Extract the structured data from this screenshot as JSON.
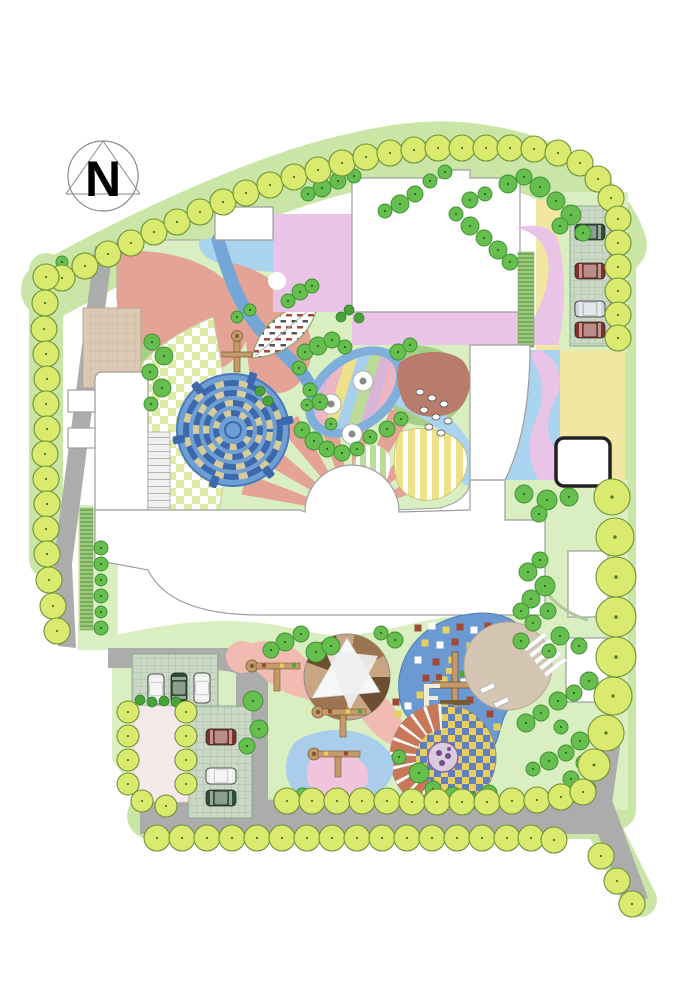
{
  "meta": {
    "north_label": "N"
  },
  "palette": {
    "paper": "#FFFFFF",
    "road": "#ACACAC",
    "roadEdge": "#979797",
    "lawn": "#D9EFC1",
    "lawnBand": "#C9E6A6",
    "treeYG": "#D9EA6F",
    "treeYGs": "#6F9238",
    "treeMG": "#66BE4E",
    "treeMGs": "#3E8F31",
    "shrubDark": "#47A33A",
    "salmon": "#E4A395",
    "salmonLight": "#F2BBB1",
    "blueStream": "#74A7D8",
    "blueLight": "#A9D3EF",
    "purple": "#D9ACDB",
    "pinkBig": "#EAC4E6",
    "greenBand": "#A5CF86",
    "yellowPale": "#F1E6A2",
    "terracotta": "#B97C6C",
    "mazeBlue": "#6D9FD4",
    "mazeWall": "#3C68AE",
    "mazeTan": "#D8CB9A",
    "beige": "#D5C6B4",
    "blueZone": "#6B9AD2",
    "pondBlue": "#ABCDEC",
    "pondPink": "#F0C4DD",
    "wood": "#C49A6A",
    "woodDark": "#7A5A32",
    "carWhite": "#EDEDED",
    "carGreen": "#2F4F33",
    "carRed": "#7E312A",
    "carSilver": "#CFD4DA",
    "outline": "#9E9E9E",
    "tanPlaza": "#DBC9B3",
    "arcTer": "#C87858",
    "checkYellow": "#E9CE5E",
    "checkBlue": "#5F7FBE",
    "pixelRed": "#A14A38",
    "pixelYellow": "#E8D05E",
    "hedge": "#9CCB7E"
  },
  "trees": {
    "perimeter": [
      [
        62,
        278
      ],
      [
        85,
        266
      ],
      [
        108,
        254
      ],
      [
        131,
        243
      ],
      [
        154,
        232
      ],
      [
        177,
        222
      ],
      [
        200,
        212
      ],
      [
        223,
        202
      ],
      [
        246,
        193
      ],
      [
        270,
        185
      ],
      [
        294,
        177
      ],
      [
        318,
        170
      ],
      [
        342,
        163
      ],
      [
        366,
        157
      ],
      [
        390,
        153
      ],
      [
        414,
        150
      ],
      [
        438,
        148
      ],
      [
        462,
        148
      ],
      [
        486,
        148
      ],
      [
        510,
        148
      ],
      [
        534,
        149
      ],
      [
        558,
        153
      ],
      [
        580,
        163
      ],
      [
        598,
        179
      ],
      [
        611,
        198
      ],
      [
        618,
        219
      ],
      [
        618,
        243
      ],
      [
        618,
        267
      ],
      [
        618,
        291
      ],
      [
        618,
        315
      ],
      [
        618,
        338
      ],
      [
        46,
        277
      ],
      [
        45,
        303
      ],
      [
        44,
        329
      ],
      [
        46,
        354
      ],
      [
        47,
        379
      ],
      [
        46,
        404
      ],
      [
        47,
        429
      ],
      [
        45,
        454
      ],
      [
        46,
        479
      ],
      [
        47,
        504
      ],
      [
        46,
        529
      ],
      [
        47,
        554
      ],
      [
        49,
        580
      ],
      [
        53,
        606
      ],
      [
        57,
        631
      ],
      [
        287,
        801
      ],
      [
        312,
        801
      ],
      [
        337,
        801
      ],
      [
        362,
        801
      ],
      [
        387,
        801
      ],
      [
        412,
        802
      ],
      [
        437,
        802
      ],
      [
        462,
        802
      ],
      [
        487,
        802
      ],
      [
        512,
        801
      ],
      [
        537,
        800
      ],
      [
        561,
        797
      ],
      [
        583,
        792
      ],
      [
        157,
        838
      ],
      [
        182,
        838
      ],
      [
        207,
        838
      ],
      [
        232,
        838
      ],
      [
        257,
        838
      ],
      [
        282,
        838
      ],
      [
        307,
        838
      ],
      [
        332,
        838
      ],
      [
        357,
        838
      ],
      [
        382,
        838
      ],
      [
        407,
        838
      ],
      [
        432,
        838
      ],
      [
        457,
        838
      ],
      [
        482,
        838
      ],
      [
        507,
        838
      ],
      [
        531,
        838
      ],
      [
        554,
        840
      ],
      [
        601,
        856
      ],
      [
        617,
        881
      ],
      [
        632,
        904
      ],
      [
        128,
        712,
        11
      ],
      [
        128,
        736,
        11
      ],
      [
        128,
        760,
        11
      ],
      [
        128,
        784,
        11
      ],
      [
        142,
        801,
        11
      ],
      [
        166,
        806,
        11
      ],
      [
        186,
        712,
        11
      ],
      [
        186,
        736,
        11
      ],
      [
        186,
        760,
        11
      ],
      [
        186,
        784,
        11
      ]
    ],
    "perimeterBig": [
      [
        612,
        497,
        18
      ],
      [
        615,
        537,
        19
      ],
      [
        616,
        577,
        20
      ],
      [
        616,
        617,
        20
      ],
      [
        616,
        657,
        20
      ],
      [
        613,
        696,
        19
      ],
      [
        606,
        733,
        18
      ],
      [
        594,
        765,
        16
      ]
    ],
    "canopy": [
      [
        322,
        188,
        9
      ],
      [
        338,
        181,
        8
      ],
      [
        308,
        194,
        7
      ],
      [
        354,
        176,
        7
      ],
      [
        508,
        184,
        9
      ],
      [
        524,
        177,
        8
      ],
      [
        540,
        187,
        10
      ],
      [
        556,
        201,
        9
      ],
      [
        571,
        215,
        10
      ],
      [
        560,
        226,
        8
      ],
      [
        470,
        200,
        8
      ],
      [
        485,
        194,
        7
      ],
      [
        445,
        172,
        7
      ],
      [
        430,
        181,
        7
      ],
      [
        415,
        194,
        8
      ],
      [
        400,
        204,
        9
      ],
      [
        385,
        211,
        7
      ],
      [
        456,
        214,
        7
      ],
      [
        470,
        226,
        9
      ],
      [
        484,
        238,
        8
      ],
      [
        498,
        250,
        9
      ],
      [
        510,
        262,
        8
      ],
      [
        583,
        233,
        8
      ],
      [
        62,
        262,
        6
      ],
      [
        152,
        342,
        8
      ],
      [
        164,
        356,
        9
      ],
      [
        150,
        372,
        8
      ],
      [
        162,
        388,
        9
      ],
      [
        151,
        404,
        7
      ],
      [
        300,
        292,
        8
      ],
      [
        288,
        301,
        7
      ],
      [
        312,
        286,
        7
      ],
      [
        305,
        352,
        8
      ],
      [
        318,
        346,
        9
      ],
      [
        332,
        340,
        8
      ],
      [
        345,
        347,
        7
      ],
      [
        299,
        368,
        7
      ],
      [
        398,
        352,
        8
      ],
      [
        410,
        345,
        7
      ],
      [
        302,
        430,
        8
      ],
      [
        314,
        441,
        9
      ],
      [
        327,
        449,
        8
      ],
      [
        342,
        453,
        8
      ],
      [
        357,
        449,
        7
      ],
      [
        331,
        424,
        6
      ],
      [
        370,
        437,
        7
      ],
      [
        387,
        429,
        8
      ],
      [
        401,
        419,
        7
      ],
      [
        310,
        390,
        7
      ],
      [
        320,
        402,
        8
      ],
      [
        307,
        405,
        6
      ],
      [
        237,
        317,
        6
      ],
      [
        250,
        310,
        6
      ],
      [
        524,
        494,
        9
      ],
      [
        547,
        500,
        10
      ],
      [
        569,
        497,
        9
      ],
      [
        539,
        514,
        8
      ],
      [
        540,
        560,
        8
      ],
      [
        528,
        572,
        9
      ],
      [
        545,
        586,
        10
      ],
      [
        531,
        599,
        9
      ],
      [
        548,
        611,
        8
      ],
      [
        533,
        623,
        8
      ],
      [
        560,
        636,
        9
      ],
      [
        579,
        646,
        8
      ],
      [
        549,
        651,
        7
      ],
      [
        521,
        641,
        8
      ],
      [
        589,
        681,
        9
      ],
      [
        574,
        693,
        8
      ],
      [
        558,
        701,
        9
      ],
      [
        541,
        713,
        8
      ],
      [
        526,
        723,
        9
      ],
      [
        561,
        727,
        7
      ],
      [
        580,
        741,
        9
      ],
      [
        566,
        753,
        8
      ],
      [
        549,
        761,
        9
      ],
      [
        584,
        763,
        8
      ],
      [
        533,
        769,
        7
      ],
      [
        571,
        779,
        8
      ],
      [
        588,
        789,
        8
      ],
      [
        560,
        791,
        7
      ],
      [
        285,
        642,
        9
      ],
      [
        301,
        634,
        8
      ],
      [
        271,
        650,
        8
      ],
      [
        316,
        652,
        10
      ],
      [
        331,
        646,
        9
      ],
      [
        395,
        640,
        8
      ],
      [
        381,
        633,
        7
      ],
      [
        253,
        701,
        10
      ],
      [
        259,
        729,
        9
      ],
      [
        247,
        746,
        8
      ],
      [
        303,
        796,
        8
      ],
      [
        319,
        801,
        7
      ],
      [
        419,
        773,
        10
      ],
      [
        433,
        789,
        8
      ],
      [
        453,
        796,
        9
      ],
      [
        471,
        801,
        8
      ],
      [
        489,
        793,
        8
      ],
      [
        399,
        757,
        7
      ],
      [
        521,
        611,
        8
      ],
      [
        101,
        548,
        7
      ],
      [
        101,
        564,
        7
      ],
      [
        101,
        580,
        6
      ],
      [
        101,
        596,
        7
      ],
      [
        101,
        612,
        6
      ],
      [
        101,
        628,
        7
      ]
    ],
    "shrubs": [
      [
        140,
        700
      ],
      [
        152,
        702
      ],
      [
        164,
        701
      ],
      [
        176,
        702
      ],
      [
        349,
        310
      ],
      [
        359,
        318
      ],
      [
        341,
        317
      ],
      [
        260,
        391
      ],
      [
        268,
        401
      ]
    ]
  },
  "stones": [
    [
      420,
      392
    ],
    [
      432,
      398
    ],
    [
      444,
      404
    ],
    [
      424,
      410
    ],
    [
      436,
      417
    ],
    [
      448,
      421
    ],
    [
      429,
      427
    ],
    [
      441,
      433
    ]
  ],
  "pixels": [
    [
      418,
      628,
      "r"
    ],
    [
      432,
      626,
      "w"
    ],
    [
      446,
      630,
      "y"
    ],
    [
      460,
      627,
      "r"
    ],
    [
      474,
      630,
      "w"
    ],
    [
      488,
      626,
      "r"
    ],
    [
      425,
      643,
      "y"
    ],
    [
      440,
      645,
      "w"
    ],
    [
      455,
      642,
      "r"
    ],
    [
      470,
      646,
      "y"
    ],
    [
      484,
      644,
      "w"
    ],
    [
      418,
      660,
      "w"
    ],
    [
      436,
      662,
      "r"
    ],
    [
      452,
      660,
      "y"
    ],
    [
      468,
      663,
      "w"
    ],
    [
      482,
      661,
      "r"
    ],
    [
      426,
      678,
      "r"
    ],
    [
      444,
      680,
      "y"
    ],
    [
      464,
      682,
      "w"
    ],
    [
      480,
      679,
      "y"
    ],
    [
      420,
      695,
      "y"
    ],
    [
      470,
      700,
      "r"
    ],
    [
      486,
      697,
      "w"
    ],
    [
      490,
      714,
      "r"
    ],
    [
      497,
      727,
      "y"
    ],
    [
      396,
      702,
      "r"
    ],
    [
      408,
      706,
      "w"
    ],
    [
      398,
      714,
      "y"
    ]
  ],
  "cars": [
    {
      "x": 590,
      "y": 232,
      "rot": 0,
      "c": "carGreen"
    },
    {
      "x": 590,
      "y": 271,
      "rot": 0,
      "c": "carRed"
    },
    {
      "x": 590,
      "y": 309,
      "rot": 0,
      "c": "carSilver"
    },
    {
      "x": 590,
      "y": 330,
      "rot": 0,
      "c": "carRed"
    },
    {
      "x": 156,
      "y": 689,
      "rot": 90,
      "c": "carWhite"
    },
    {
      "x": 179,
      "y": 688,
      "rot": 90,
      "c": "carGreen"
    },
    {
      "x": 202,
      "y": 688,
      "rot": 90,
      "c": "carWhite"
    },
    {
      "x": 221,
      "y": 737,
      "rot": 0,
      "c": "carRed"
    },
    {
      "x": 221,
      "y": 776,
      "rot": 0,
      "c": "carWhite"
    },
    {
      "x": 221,
      "y": 798,
      "rot": 0,
      "c": "carGreen"
    }
  ]
}
